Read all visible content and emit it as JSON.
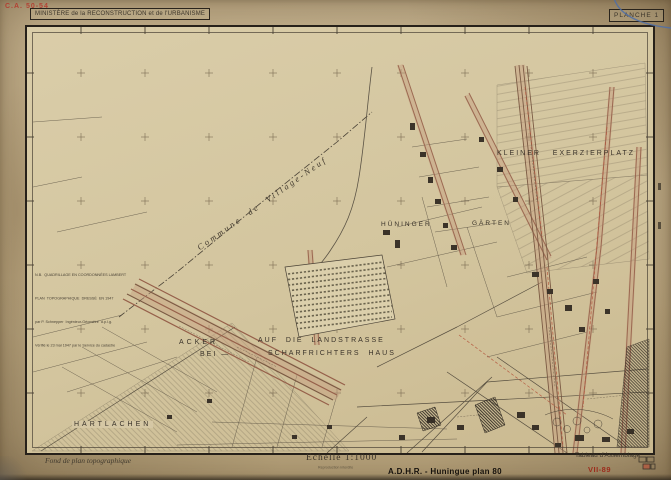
{
  "stamp": {
    "code": "C.A. 50-54"
  },
  "header": {
    "ministry": "MINISTÈRE de la RECONSTRUCTION et de l'URBANISME",
    "title": "HUNINGUE",
    "department": "Haut Rhin",
    "plate": "PLANCHE 1"
  },
  "note_block": {
    "line1": "N.B.  QUADRILLAGE EN COORDONNÉES LAMBERT",
    "line2": "PLAN  TOPOGRAPHIQUE  DRESSÉ  EN 1947",
    "line3": "par P. Schnepper  Ingénieur-Géomètre  d.p.l.g.",
    "line4": "Vérifié le 23 mai 1947 par le Service du cadastre"
  },
  "map_labels": {
    "commune": "Commune  de  Village-Neuf",
    "kleiner": "KLEINER   EXERZIERPLATZ",
    "huninger": "HÜNINGER",
    "garten": "GÄRTEN",
    "acker": "ACKER",
    "bei": "BEI —",
    "landstrasse": "AUF  DIE  LANDSTRASSE",
    "scharfrichters": "SCHARFRICHTERS  HAUS",
    "hartlachen": "HARTLACHEN"
  },
  "footer": {
    "left_note": "Fond de plan topographique",
    "scale": "Echelle 1:1000",
    "scale_sub": "Reproduction interdite",
    "assemblage": "Tableau d'Assemblage",
    "archive_ref": "A.D.H.R. - Huningue plan 80",
    "cote": "VII-89"
  },
  "colors": {
    "paper": "#c2af8b",
    "map_paper": "#d7caa7",
    "title_red": "#7a1b26",
    "stamp_red": "#b43a2e",
    "cote_red": "#9c2c1c",
    "ink": "#3c352a",
    "road_brown": "#96604a",
    "pen_blue": "#4d6fa8"
  }
}
